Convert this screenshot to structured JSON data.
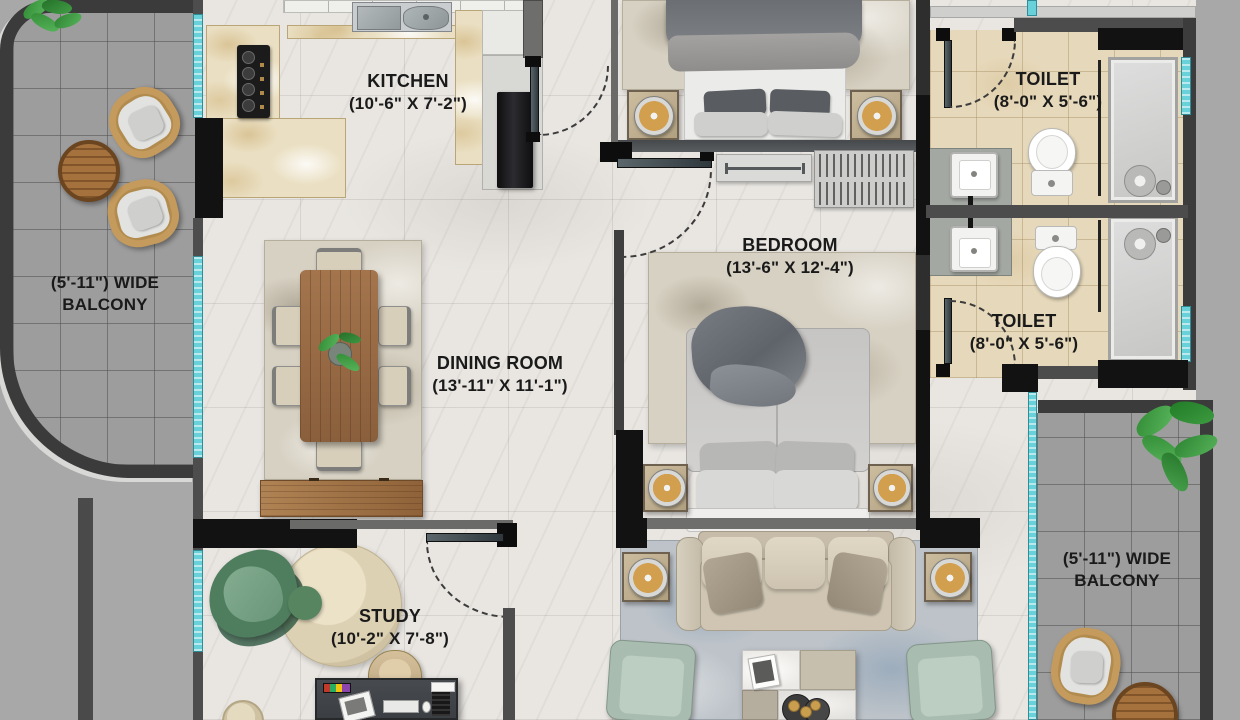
{
  "meta": {
    "type": "residential-floor-plan",
    "view": "top-down-render"
  },
  "rooms": [
    {
      "id": "kitchen",
      "label": "KITCHEN",
      "dims": "(10'-6\" X 7'-2\")"
    },
    {
      "id": "bedroom",
      "label": "BEDROOM",
      "dims": "(13'-6\" X 12'-4\")"
    },
    {
      "id": "dining-room",
      "label": "DINING ROOM",
      "dims": "(13'-11\" X 11'-1\")"
    },
    {
      "id": "toilet-top",
      "label": "TOILET",
      "dims": "(8'-0\" X 5'-6\")"
    },
    {
      "id": "toilet-mid",
      "label": "TOILET",
      "dims": "(8'-0\" X 5'-6\")"
    },
    {
      "id": "study",
      "label": "STUDY",
      "dims": "(10'-2\" X 7'-8\")"
    },
    {
      "id": "balcony-left",
      "line1": "(5'-11\") WIDE",
      "line2": "BALCONY"
    },
    {
      "id": "balcony-right",
      "line1": "(5'-11\") WIDE",
      "line2": "BALCONY"
    }
  ],
  "palette": {
    "outer_background": "#a8a8a8",
    "marble_floor": "#e9e6e2",
    "balcony_tile": "#9d9d9d",
    "toilet_tile": "#e6d8ba",
    "counter_marble": "#eadfc2",
    "wall_dark": "#121212",
    "wall_grey": "#4d4d4d",
    "window_teal": "#68d1da",
    "wood": "#a5713d",
    "sofa_beige": "#cfc5b2",
    "armchair_sage": "#a9bcb0",
    "lounge_green": "#4f7e5e",
    "label_text": "#1a1a1a"
  },
  "furniture": [
    "bed",
    "nightstand",
    "table-lamp",
    "wardrobe-console",
    "slatted-rack",
    "dining-table",
    "dining-chair",
    "sideboard",
    "sofa",
    "throw-pillow",
    "side-table",
    "armchair",
    "coffee-table",
    "study-desk",
    "desk-chair",
    "lounge-chair",
    "round-rug",
    "pouf",
    "wash-basin",
    "toilet-wc",
    "shower",
    "gas-stove",
    "kitchen-sink",
    "refrigerator",
    "outdoor-chair",
    "outdoor-round-table",
    "plant"
  ]
}
